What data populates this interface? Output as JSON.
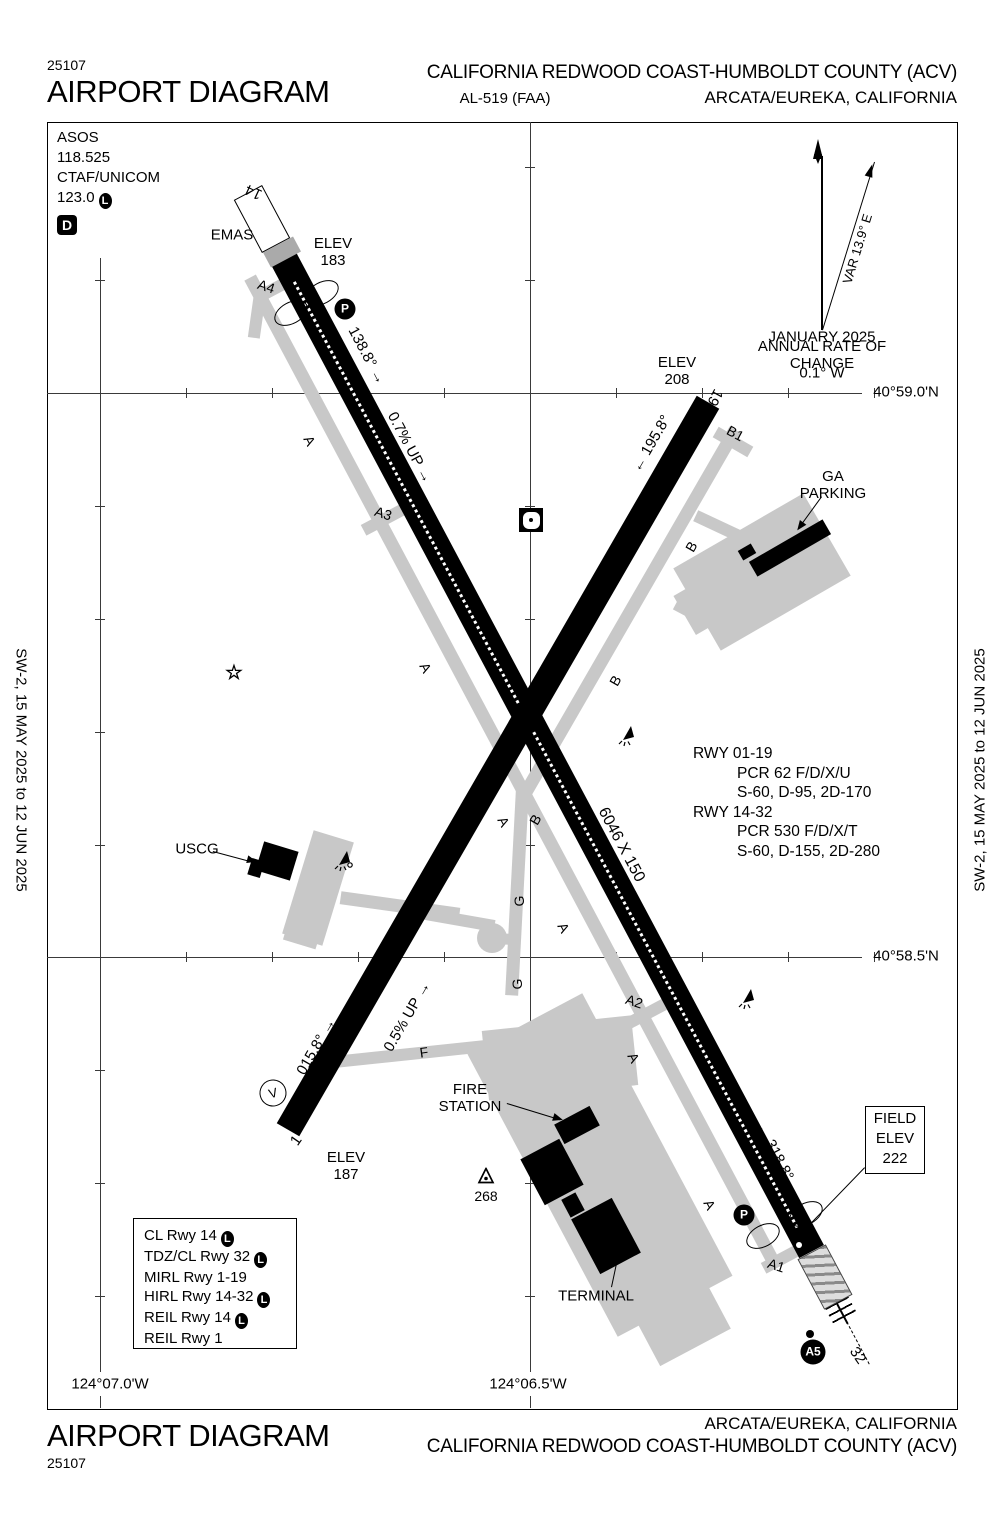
{
  "header": {
    "chart_number": "25107",
    "title": "AIRPORT DIAGRAM",
    "airport_name": "CALIFORNIA REDWOOD COAST-HUMBOLDT COUNTY (ACV)",
    "procedure_id": "AL-519 (FAA)",
    "city": "ARCATA/EUREKA, CALIFORNIA"
  },
  "footer": {
    "title": "AIRPORT DIAGRAM",
    "chart_number": "25107",
    "city": "ARCATA/EUREKA, CALIFORNIA",
    "airport_name": "CALIFORNIA REDWOOD COAST-HUMBOLDT COUNTY (ACV)"
  },
  "margins": {
    "left": "SW-2,  15 MAY 2025  to  12 JUN 2025",
    "right": "SW-2,  15 MAY 2025  to  12 JUN 2025"
  },
  "info_box": {
    "asos_label": "ASOS",
    "asos_freq": "118.525",
    "ctaf_label": "CTAF/UNICOM",
    "ctaf_freq": "123.0",
    "airspace_class": "D"
  },
  "field_elev": {
    "line1": "FIELD",
    "line2": "ELEV",
    "line3": "222"
  },
  "symbols": {
    "helipad": "P",
    "holding_position": "A5",
    "vasi": "V",
    "lighting": "L",
    "beacon_star": "☆"
  },
  "runway_info": [
    {
      "text": "RWY 01-19",
      "indent": false
    },
    {
      "text": "PCR 62 F/D/X/U",
      "indent": true
    },
    {
      "text": "S-60, D-95, 2D-170",
      "indent": true
    },
    {
      "text": "RWY 14-32",
      "indent": false
    },
    {
      "text": "PCR 530 F/D/X/T",
      "indent": true
    },
    {
      "text": "S-60, D-155, 2D-280",
      "indent": true
    }
  ],
  "lighting_legend": [
    {
      "text": "CL Rwy 14",
      "l": true
    },
    {
      "text": "TDZ/CL Rwy 32",
      "l": true
    },
    {
      "text": "MIRL Rwy 1-19",
      "l": false
    },
    {
      "text": "HIRL Rwy 14-32",
      "l": true
    },
    {
      "text": "REIL Rwy 14",
      "l": true
    },
    {
      "text": "REIL Rwy 1",
      "l": false
    }
  ],
  "map_labels": [
    {
      "name": "emas-label",
      "text": "EMAS",
      "x": 232,
      "y": 236,
      "fs": 15
    },
    {
      "name": "rwy14-elev",
      "text": "ELEV\n183",
      "x": 333,
      "y": 253,
      "fs": 15
    },
    {
      "name": "rwy14-number",
      "text": "14",
      "x": 254,
      "y": 191,
      "rot": 205,
      "fs": 15
    },
    {
      "name": "taxiway-label-a4",
      "text": "A4",
      "x": 266,
      "y": 287,
      "rot": 18,
      "fs": 14
    },
    {
      "name": "rwy14-heading",
      "text": "138.8° →",
      "x": 366,
      "y": 356,
      "rot": 62,
      "fs": 15
    },
    {
      "name": "rwy1432-slope",
      "text": "0.7% UP →",
      "x": 409,
      "y": 448,
      "rot": 62,
      "fs": 15
    },
    {
      "name": "rwy19-elev",
      "text": "ELEV\n208",
      "x": 677,
      "y": 372,
      "fs": 15
    },
    {
      "name": "rwy19-number",
      "text": "19",
      "x": 714,
      "y": 397,
      "rot": 118,
      "fs": 15
    },
    {
      "name": "taxiway-label-b1",
      "text": "B1",
      "x": 735,
      "y": 434,
      "rot": 28,
      "fs": 14
    },
    {
      "name": "rwy19-heading",
      "text": "← 195.8°",
      "x": 652,
      "y": 444,
      "rot": -60,
      "fs": 15
    },
    {
      "name": "ga-parking-label",
      "text": "GA\nPARKING",
      "x": 833,
      "y": 486,
      "fs": 15
    },
    {
      "name": "magnetic-variation",
      "text": "VAR 13.9° E",
      "x": 858,
      "y": 249,
      "rot": -73,
      "fs": 13
    },
    {
      "name": "magvar-date",
      "text": "JANUARY 2025",
      "x": 822,
      "y": 338,
      "fs": 15
    },
    {
      "name": "magvar-rate-label",
      "text": "ANNUAL RATE OF CHANGE",
      "x": 822,
      "y": 356,
      "fs": 15
    },
    {
      "name": "magvar-rate",
      "text": "0.1° W",
      "x": 822,
      "y": 374,
      "fs": 15
    },
    {
      "name": "latitude-59",
      "text": "40°59.0'N",
      "x": 906,
      "y": 393,
      "fs": 15
    },
    {
      "name": "latitude-585",
      "text": "40°58.5'N",
      "x": 906,
      "y": 957,
      "fs": 15
    },
    {
      "name": "longitude-07",
      "text": "124°07.0'W",
      "x": 110,
      "y": 1385,
      "fs": 15
    },
    {
      "name": "longitude-065",
      "text": "124°06.5'W",
      "x": 528,
      "y": 1385,
      "fs": 15
    },
    {
      "name": "taxiway-label-a",
      "text": "A",
      "x": 309,
      "y": 441,
      "rot": 62,
      "fs": 14
    },
    {
      "name": "taxiway-label-a",
      "text": "A",
      "x": 425,
      "y": 668,
      "rot": 62,
      "fs": 14
    },
    {
      "name": "taxiway-label-a",
      "text": "A",
      "x": 503,
      "y": 822,
      "rot": 62,
      "fs": 14
    },
    {
      "name": "taxiway-label-a",
      "text": "A",
      "x": 563,
      "y": 928,
      "rot": 62,
      "fs": 14
    },
    {
      "name": "taxiway-label-a",
      "text": "A",
      "x": 633,
      "y": 1058,
      "rot": 62,
      "fs": 14
    },
    {
      "name": "taxiway-label-a",
      "text": "A",
      "x": 709,
      "y": 1205,
      "rot": 62,
      "fs": 14
    },
    {
      "name": "taxiway-label-b",
      "text": "B",
      "x": 692,
      "y": 547,
      "rot": -60,
      "fs": 14
    },
    {
      "name": "taxiway-label-b",
      "text": "B",
      "x": 616,
      "y": 681,
      "rot": -60,
      "fs": 14
    },
    {
      "name": "taxiway-label-b",
      "text": "B",
      "x": 536,
      "y": 820,
      "rot": -60,
      "fs": 14
    },
    {
      "name": "taxiway-label-g",
      "text": "G",
      "x": 520,
      "y": 901,
      "rot": -90,
      "fs": 14
    },
    {
      "name": "taxiway-label-g",
      "text": "G",
      "x": 518,
      "y": 984,
      "rot": -90,
      "fs": 14
    },
    {
      "name": "taxiway-label-f",
      "text": "F",
      "x": 424,
      "y": 1053,
      "rot": -8,
      "fs": 14
    },
    {
      "name": "taxiway-label-a3",
      "text": "A3",
      "x": 383,
      "y": 514,
      "rot": 18,
      "fs": 14
    },
    {
      "name": "taxiway-label-a2",
      "text": "A2",
      "x": 634,
      "y": 1002,
      "rot": 18,
      "fs": 14
    },
    {
      "name": "taxiway-label-a1",
      "text": "A1",
      "x": 776,
      "y": 1266,
      "rot": 18,
      "fs": 14
    },
    {
      "name": "rwy0119-dimensions",
      "text": "4501 X 150",
      "x": 453,
      "y": 846,
      "rot": -60,
      "fs": 16
    },
    {
      "name": "rwy1432-dimensions",
      "text": "6046 X 150",
      "x": 621,
      "y": 845,
      "rot": 62,
      "fs": 16
    },
    {
      "name": "uscg-label",
      "text": "USCG",
      "x": 197,
      "y": 850,
      "fs": 15
    },
    {
      "name": "rwy1-heading",
      "text": "015.8° →",
      "x": 317,
      "y": 1047,
      "rot": -60,
      "fs": 15
    },
    {
      "name": "rwy0119-slope",
      "text": "0.5% UP →",
      "x": 408,
      "y": 1017,
      "rot": -60,
      "fs": 15
    },
    {
      "name": "rwy1-number",
      "text": "1",
      "x": 297,
      "y": 1141,
      "rot": -55,
      "fs": 15
    },
    {
      "name": "rwy1-elev",
      "text": "ELEV\n187",
      "x": 346,
      "y": 1167,
      "fs": 15
    },
    {
      "name": "fire-station-label",
      "text": "FIRE\nSTATION",
      "x": 470,
      "y": 1099,
      "fs": 15
    },
    {
      "name": "obstruction-height",
      "text": "268",
      "x": 486,
      "y": 1197,
      "fs": 14
    },
    {
      "name": "terminal-label",
      "text": "TERMINAL",
      "x": 596,
      "y": 1297,
      "fs": 15
    },
    {
      "name": "rwy32-heading",
      "text": "← 318.8°",
      "x": 774,
      "y": 1152,
      "rot": 62,
      "fs": 15
    },
    {
      "name": "rwy32-number",
      "text": "32",
      "x": 857,
      "y": 1356,
      "rot": 55,
      "fs": 15
    }
  ]
}
